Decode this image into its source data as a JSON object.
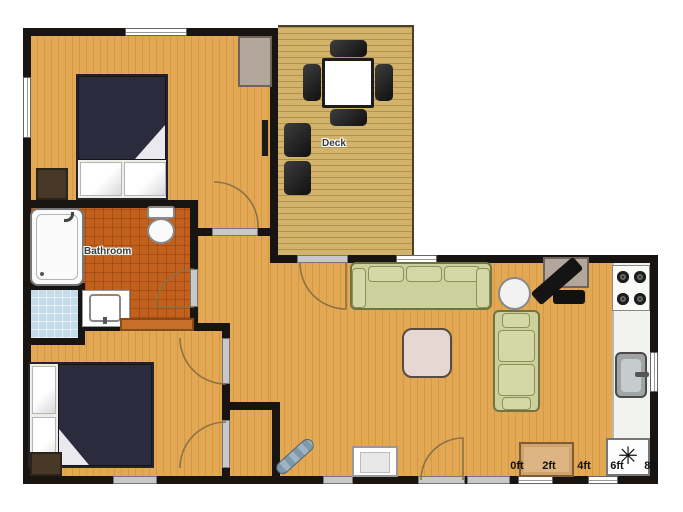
{
  "labels": {
    "deck": "Deck",
    "bathroom": "Bathroom"
  },
  "scale_bar": {
    "labels": [
      "0ft",
      "2ft",
      "4ft",
      "6ft",
      "8ft"
    ]
  },
  "icons": {
    "fridge_snowflake": "✳"
  },
  "colors": {
    "wall": "#171411",
    "wood_floor": "#E3A853",
    "deck_wood": "#D3B269",
    "bathroom_tile": "#C2611E",
    "closet_tile": "#C5DCEA",
    "bed_duvet": "#2B2B3D",
    "sofa": "#CBD09C",
    "coffee_table": "#E6D7D2",
    "tv_cabinet": "#B3A79B"
  }
}
